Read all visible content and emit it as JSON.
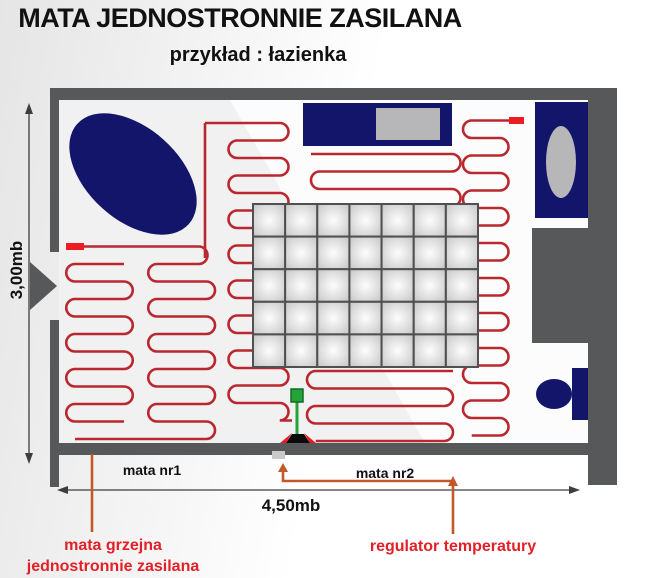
{
  "title": "MATA JEDNOSTRONNIE ZASILANA",
  "subtitle": "przykład : łazienka",
  "dimensions": {
    "height": "3,00mb",
    "width": "4,50mb"
  },
  "mat_labels": {
    "mat1": "mata nr1",
    "mat2": "mata nr2"
  },
  "callouts": {
    "heating_mat_line1": "mata grzejna",
    "heating_mat_line2": "jednostronnie zasilana",
    "regulator": "regulator temperatury"
  },
  "colors": {
    "wall": "#57585a",
    "fixture": "#13156b",
    "fixture_inner": "#b7b7ba",
    "cable": "#b9282e",
    "terminal": "#ec1b24",
    "annotation": "#c2592b",
    "callout_text": "#e32028",
    "sensor": "#22a438",
    "sensor_dark": "#116b24",
    "dim": "#3d3d3d",
    "floor": "#f1f1f2",
    "floor_light": "#fcfcfc",
    "tile_border": "#4f5052"
  }
}
